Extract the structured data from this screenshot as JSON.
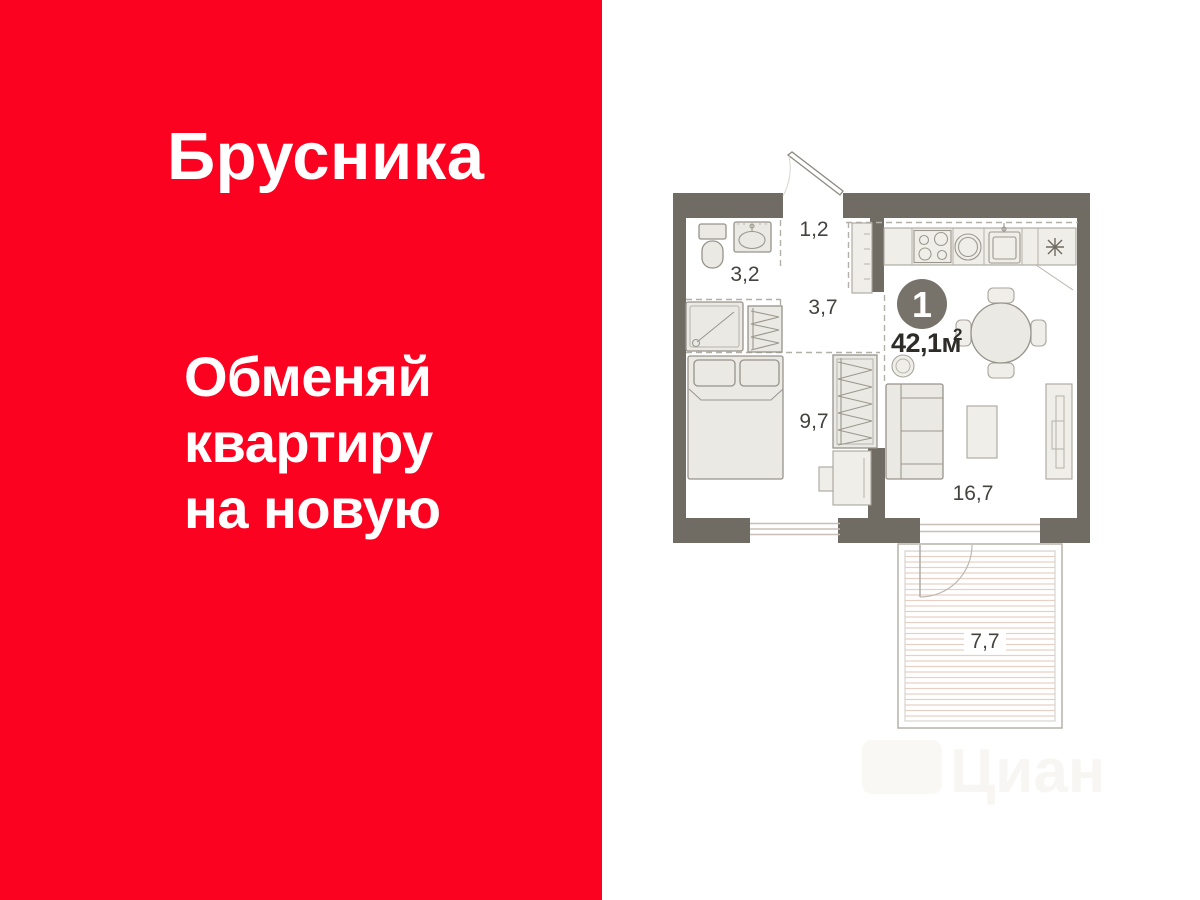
{
  "banner": {
    "brand": "Брусника",
    "slogan_lines": [
      "Обменяй",
      "квартиру",
      "на новую"
    ],
    "panel_color": "#FA0220",
    "text_color": "#FFFFFF"
  },
  "floorplan": {
    "rooms_badge": "1",
    "total_area": "42,1м",
    "total_area_superscript": "2",
    "room_labels": {
      "entry_hall": "1,2",
      "bathroom": "3,2",
      "corridor": "3,7",
      "bedroom": "9,7",
      "living_room": "16,7",
      "balcony": "7,7"
    },
    "colors": {
      "walls": "#716C63",
      "badge": "#78736A",
      "balcony_hatch": "#E7CFC4",
      "label_text": "#454340"
    }
  },
  "watermark": "Циан"
}
